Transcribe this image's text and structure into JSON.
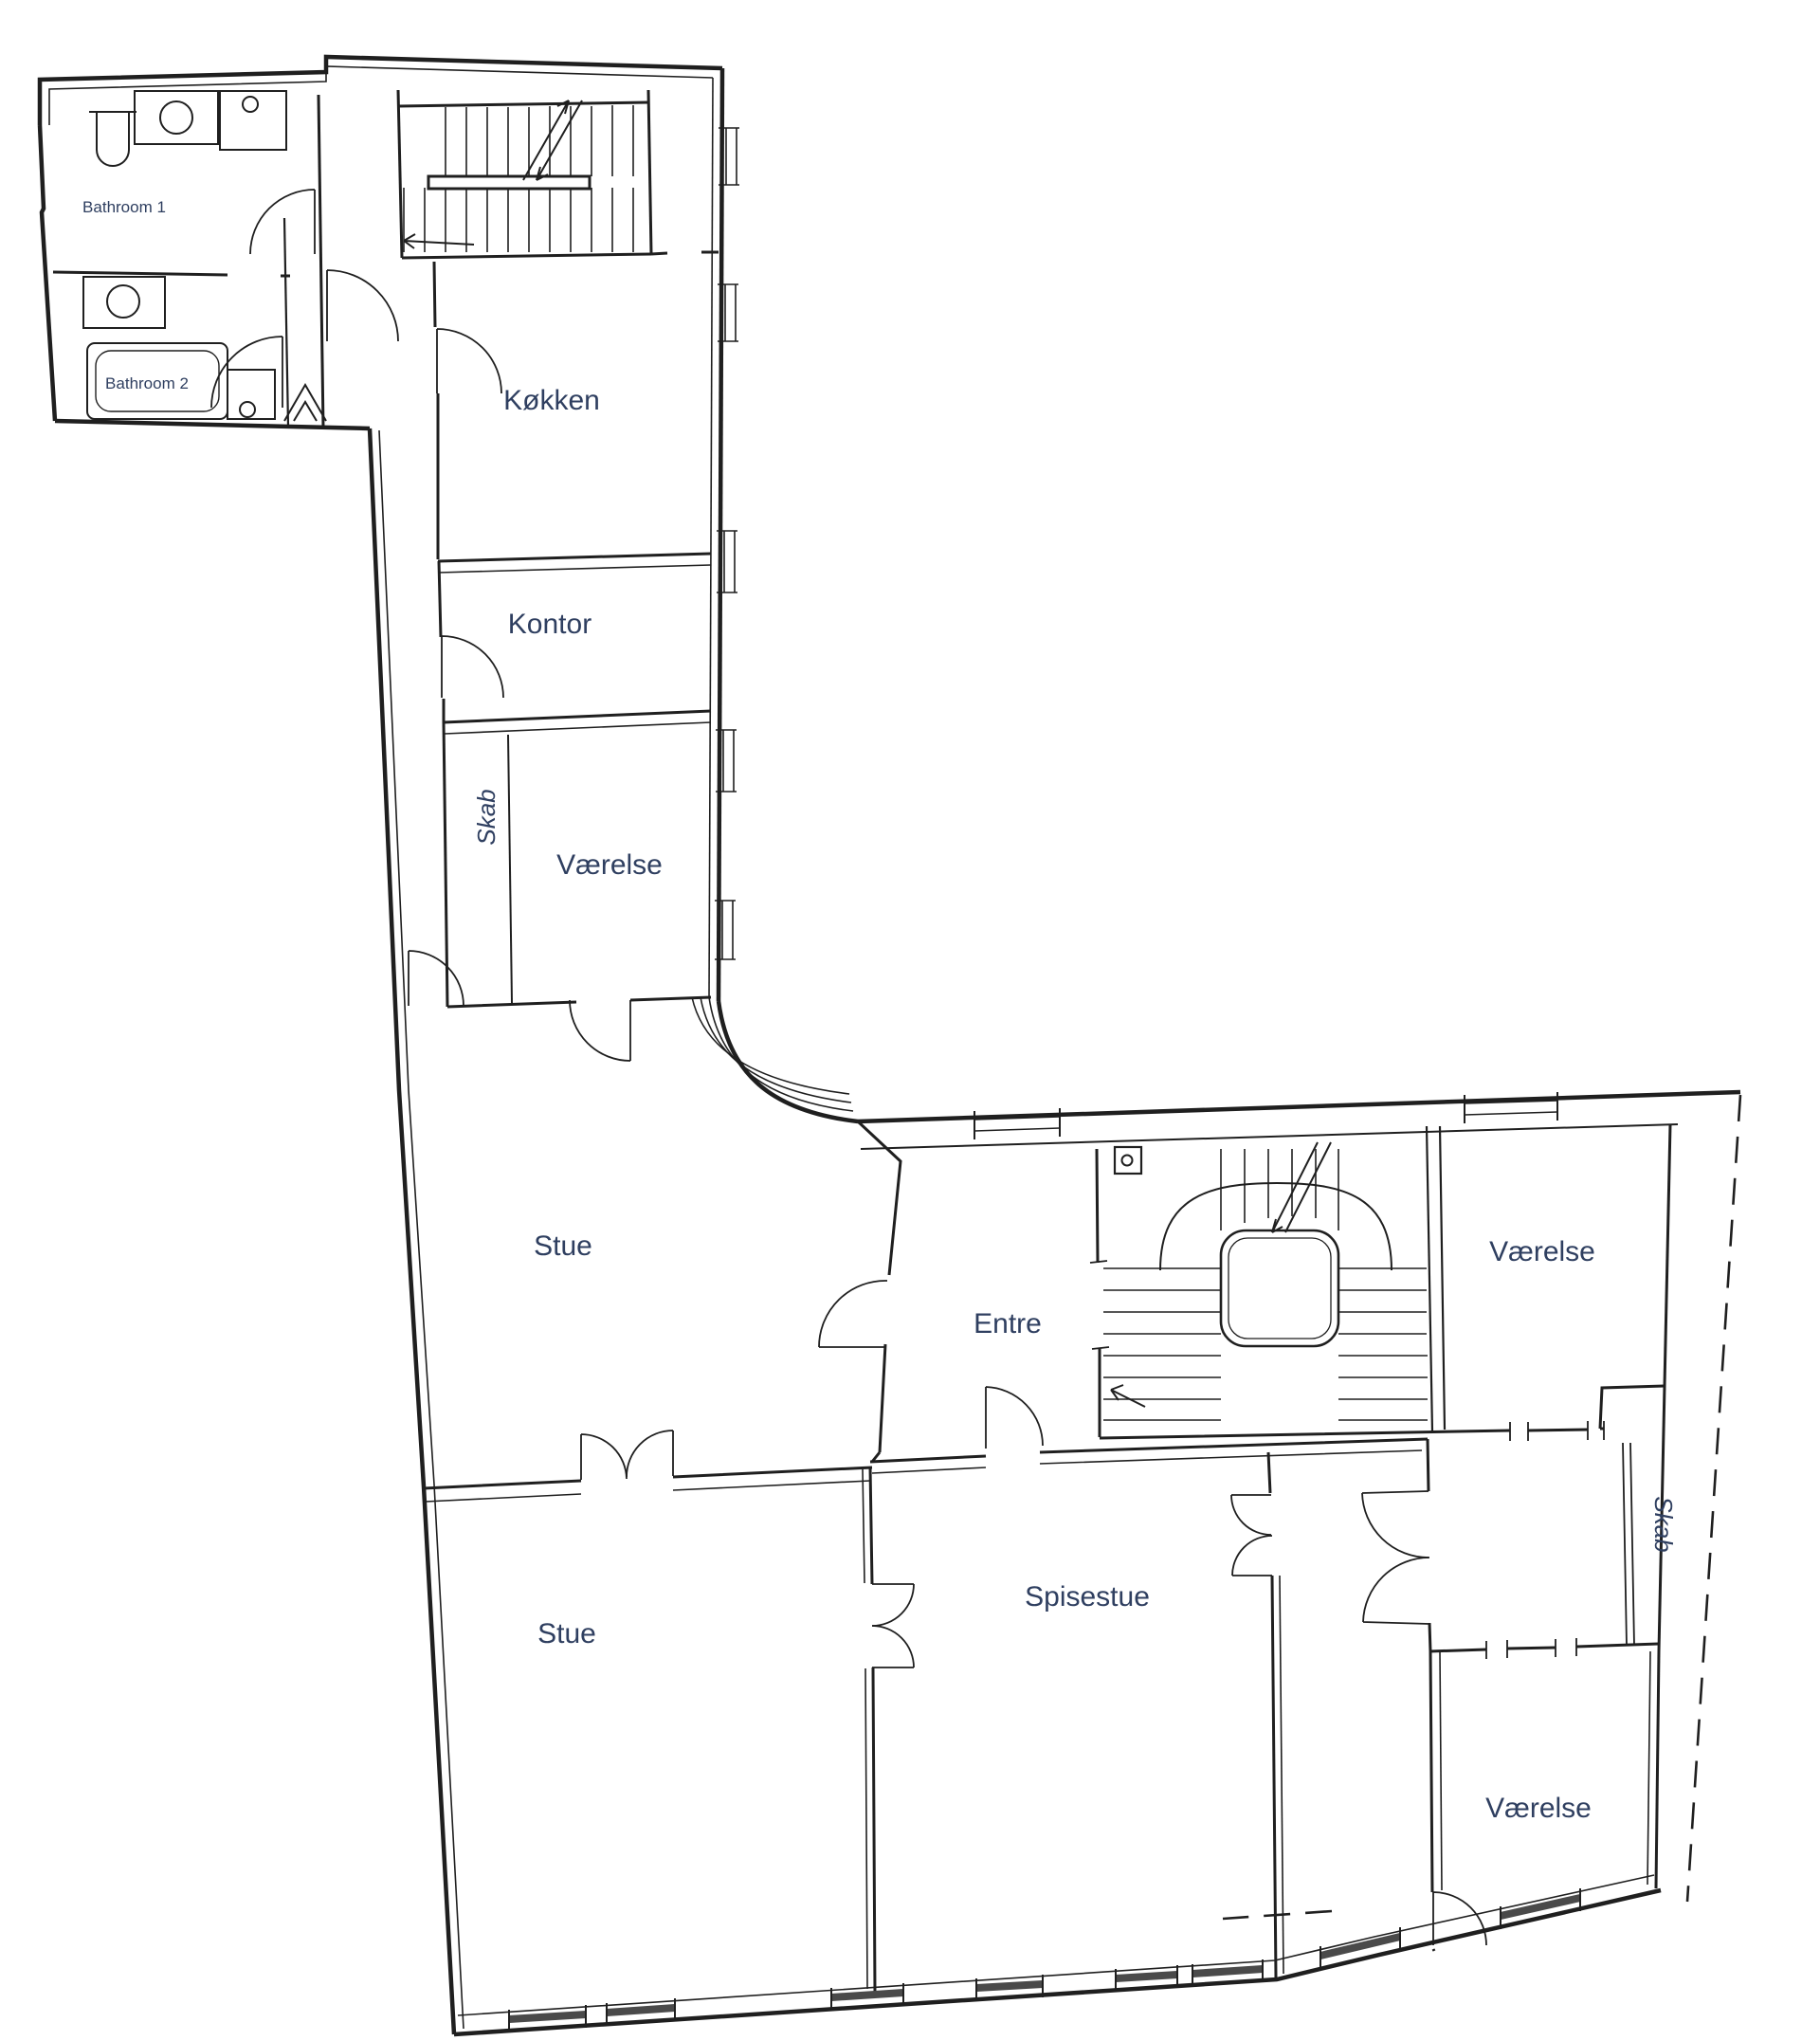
{
  "document": {
    "type": "floor-plan-drawing",
    "language": "Danish"
  },
  "colors": {
    "background": "#ffffff",
    "walls": "#1f1f1f",
    "labels": "#2f3f60",
    "window_fill": "#4a4a4a"
  },
  "rooms": [
    {
      "id": "bathroom-1",
      "label": "Bathroom 1"
    },
    {
      "id": "bathroom-2",
      "label": "Bathroom 2"
    },
    {
      "id": "koekken",
      "label": "Køkken"
    },
    {
      "id": "kontor",
      "label": "Kontor"
    },
    {
      "id": "skab-left",
      "label": "Skab"
    },
    {
      "id": "vaerelse-upper",
      "label": "Værelse"
    },
    {
      "id": "stue-upper",
      "label": "Stue"
    },
    {
      "id": "entre",
      "label": "Entre"
    },
    {
      "id": "vaerelse-top-right",
      "label": "Værelse"
    },
    {
      "id": "stue-lower",
      "label": "Stue"
    },
    {
      "id": "spisestue",
      "label": "Spisestue"
    },
    {
      "id": "skab-right",
      "label": "Skab"
    },
    {
      "id": "vaerelse-bottom-right",
      "label": "Værelse"
    }
  ]
}
